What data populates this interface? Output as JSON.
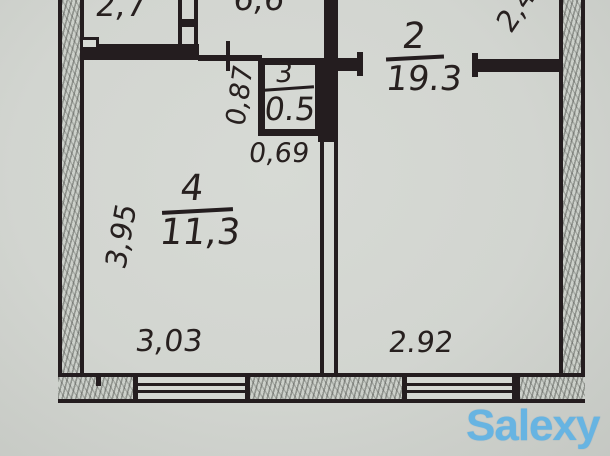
{
  "plan": {
    "rooms": [
      {
        "number": "2",
        "area": "19.3"
      },
      {
        "number": "3",
        "area": "0.5"
      },
      {
        "number": "4",
        "area": "11,3"
      }
    ],
    "dims": {
      "top_left": "2,7",
      "top_middle": "6,6",
      "top_right": "2,4",
      "niche_height": "0,87",
      "niche_width": "0,69",
      "left_side": "3,95",
      "bottom_left": "3,03",
      "bottom_right": "2.92"
    }
  },
  "watermark": {
    "text": "Salexy"
  },
  "colors": {
    "paper": "#d2d5d0",
    "ink": "#241d1f",
    "hatch_gray": "#8f918c",
    "watermark_blue": "#67b4e2"
  }
}
